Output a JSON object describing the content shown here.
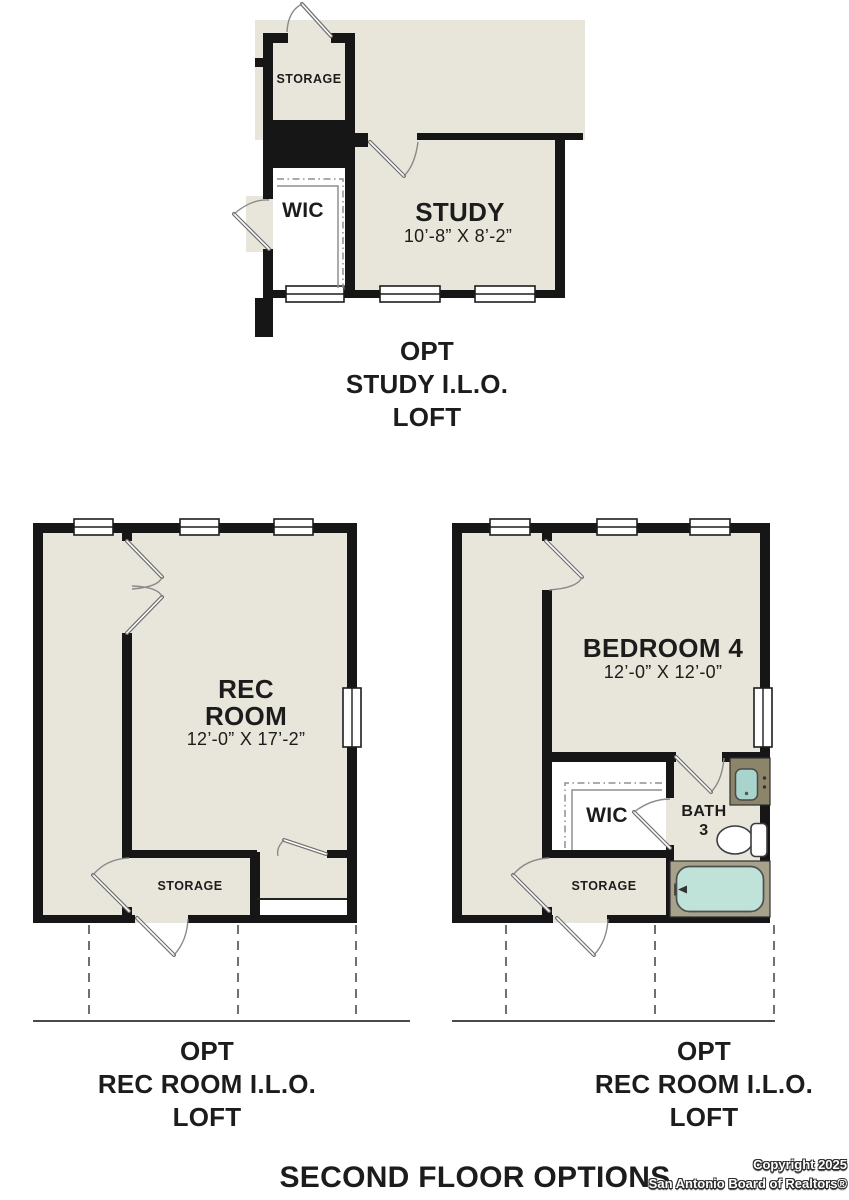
{
  "colors": {
    "wall": "#161616",
    "floor_beige": "#e8e5da",
    "fixture_teal": "#bfe2d9",
    "tub_surround_olive": "#a6a28c",
    "vanity_olive": "#8d8569"
  },
  "plans": {
    "study_option": {
      "caption": [
        "OPT",
        "STUDY I.L.O.",
        "LOFT"
      ],
      "labels": {
        "storage": "STORAGE",
        "wic": "WIC",
        "study": "STUDY",
        "study_dims": "10’-8” X 8’-2”"
      }
    },
    "rec_room_left": {
      "caption": [
        "OPT",
        "REC ROOM I.L.O.",
        "LOFT"
      ],
      "labels": {
        "rec_1": "REC",
        "rec_2": "ROOM",
        "rec_dims": "12’-0” X 17’-2”",
        "storage": "STORAGE"
      }
    },
    "rec_room_right": {
      "caption": [
        "OPT",
        "REC ROOM I.L.O.",
        "LOFT"
      ],
      "labels": {
        "bedroom": "BEDROOM 4",
        "bedroom_dims": "12’-0” X 12’-0”",
        "wic": "WIC",
        "bath_1": "BATH",
        "bath_2": "3",
        "storage": "STORAGE"
      }
    }
  },
  "footer": {
    "title": "SECOND FLOOR OPTIONS",
    "copyright_line1": "Copyright 2025",
    "copyright_line2": "San Antonio Board of Realtors®"
  }
}
